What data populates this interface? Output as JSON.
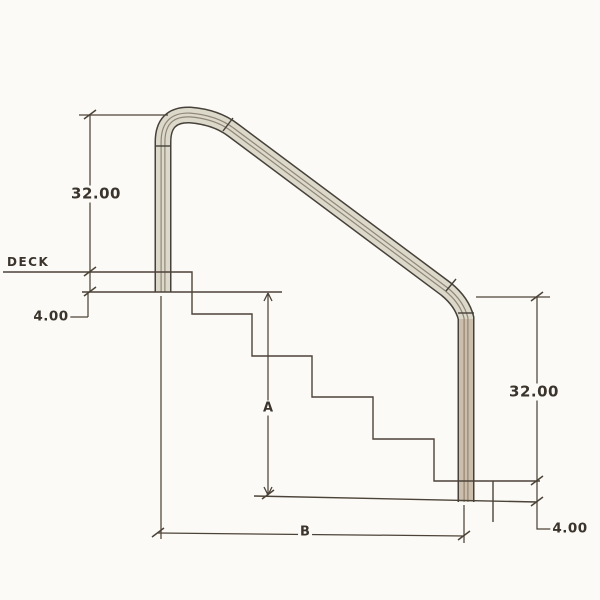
{
  "diagram": {
    "type": "technical-drawing",
    "subject": "Pool stair handrail side elevation with dimensions",
    "labels": {
      "deck": "DECK",
      "left_rail_height": "32.00",
      "left_anchor_depth": "4.00",
      "right_rail_height": "32.00",
      "right_anchor_depth": "4.00",
      "vertical_dim": "A",
      "horizontal_dim": "B"
    },
    "colors": {
      "background": "#fbfaf6",
      "line": "#4c4338",
      "rail_fill": "#dcd9ca",
      "rail_fill_right": "#cdbfb2",
      "rail_outline": "#46413a",
      "text": "#3a342c"
    }
  }
}
